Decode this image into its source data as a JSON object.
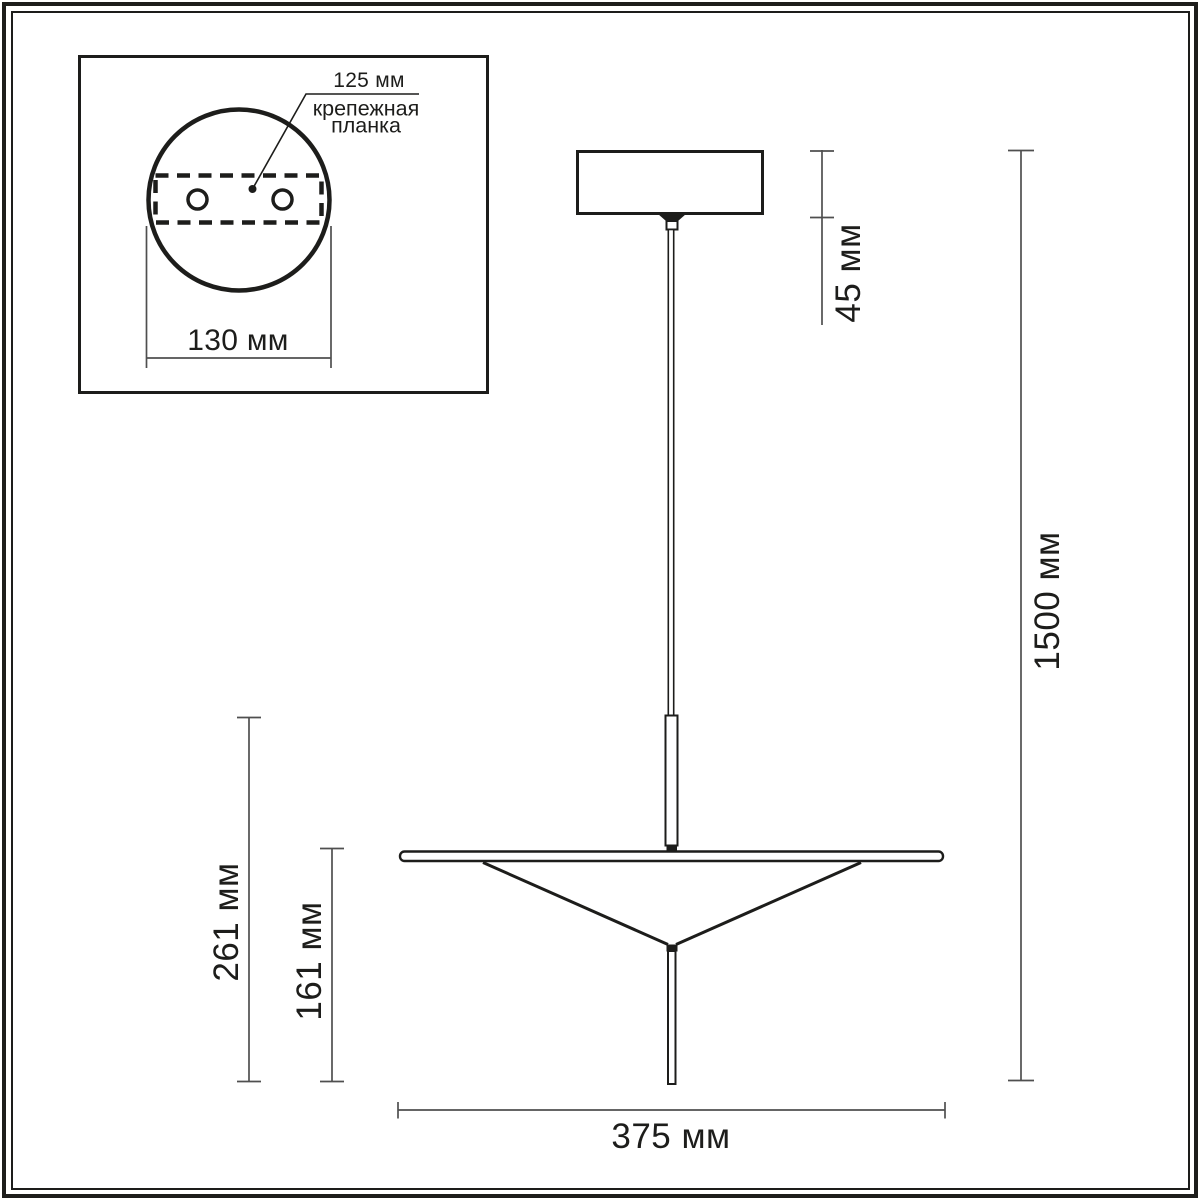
{
  "diagram": {
    "kind": "pendant-light-dimension-drawing",
    "inset": {
      "plate_offset_label": "125 мм",
      "plate_name_line1": "крепежная",
      "plate_name_line2": "планка",
      "canopy_diameter_label": "130 мм"
    },
    "dimensions": {
      "canopy_height": "45 мм",
      "overall_height": "1500 мм",
      "shade_assembly_height": "261 мм",
      "shade_height": "161 мм",
      "shade_diameter": "375 мм"
    },
    "colors": {
      "line": "#1d1d1b",
      "dimension": "#4f4f4f",
      "background": "#ffffff"
    }
  }
}
